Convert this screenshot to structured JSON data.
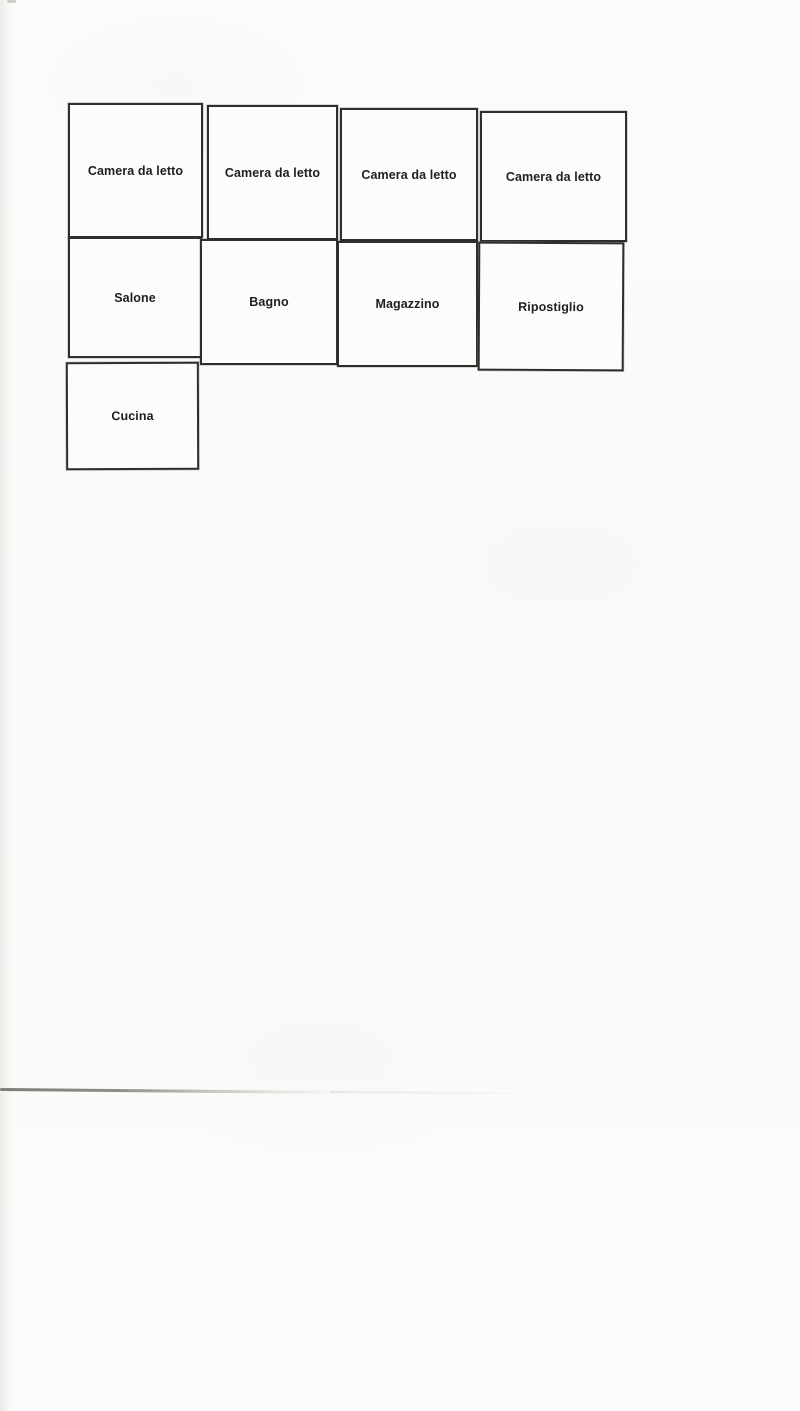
{
  "document": {
    "kind": "scanned floor plan sketch"
  },
  "floor_plan": {
    "rooms": [
      {
        "id": "camera-da-letto-1",
        "label": "Camera da letto"
      },
      {
        "id": "camera-da-letto-2",
        "label": "Camera da letto"
      },
      {
        "id": "camera-da-letto-3",
        "label": "Camera da letto"
      },
      {
        "id": "camera-da-letto-4",
        "label": "Camera da letto"
      },
      {
        "id": "salone",
        "label": "Salone"
      },
      {
        "id": "bagno",
        "label": "Bagno"
      },
      {
        "id": "magazzino",
        "label": "Magazzino"
      },
      {
        "id": "ripostiglio",
        "label": "Ripostiglio"
      },
      {
        "id": "cucina",
        "label": "Cucina"
      }
    ]
  },
  "colors": {
    "paper": "#fafaf8",
    "room_fill": "#fcfcfb",
    "room_border": "#2e2e2c",
    "label_text": "#1f1f1f",
    "fold_line": "#8f8f8a"
  }
}
